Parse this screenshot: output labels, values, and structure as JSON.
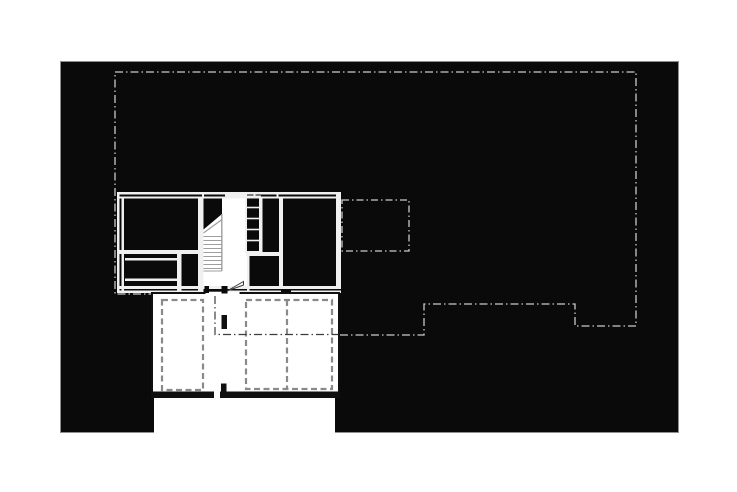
{
  "page": {
    "width": 737,
    "height": 492,
    "title": "upper-floor-plan-drawing"
  },
  "palette": {
    "page_bg": "#ffffff",
    "canvas_bg": "#0a0a0a",
    "wall_white": "#f0f0f0",
    "line_light": "#c9c9c9",
    "line_gray": "#9e9e9e",
    "line_dark": "#8a8a8a",
    "ink": "#101010",
    "ink_soft": "#3c3c3c",
    "canvas_border": "#8f8f8f"
  },
  "canvas": {
    "x": 60,
    "y": 61,
    "w": 619,
    "h": 372,
    "border_px": 1
  },
  "notch": {
    "x": 154,
    "y": 397,
    "w": 181,
    "h": 36
  },
  "drawing": {
    "elements": [
      {
        "name": "eaves-overhang-outline",
        "type": "polygon",
        "points": [
          [
            115,
            72
          ],
          [
            636,
            72
          ],
          [
            636,
            326
          ],
          [
            575,
            326
          ],
          [
            575,
            304
          ],
          [
            424,
            304
          ],
          [
            424,
            335
          ],
          [
            215,
            335
          ],
          [
            215,
            294
          ],
          [
            115,
            294
          ]
        ],
        "fill": "none",
        "stroke": "line_light",
        "sw": 1.3,
        "dash": "8 3 1.5 3"
      },
      {
        "name": "annex-dashed-outline",
        "type": "rect",
        "x": 342,
        "y": 200,
        "w": 67,
        "h": 51,
        "fill": "none",
        "stroke": "line_light",
        "sw": 1.3,
        "dash": "7 3 1.5 3"
      },
      {
        "name": "stair-hall-floor",
        "type": "rect",
        "x": 203.5,
        "y": 198,
        "w": 43.5,
        "h": 90,
        "fill": "page_bg"
      },
      {
        "name": "stair-upper-flight-mask",
        "type": "polygon",
        "points": [
          [
            203.5,
            198
          ],
          [
            222,
            198
          ],
          [
            222,
            214
          ],
          [
            203.5,
            229.5
          ]
        ],
        "fill": "canvas_bg"
      },
      {
        "name": "stair-break-line",
        "type": "line",
        "x1": 203.5,
        "y1": 233,
        "x2": 222,
        "y2": 219.5,
        "stroke": "line_gray",
        "sw": 1.2
      },
      {
        "name": "stair-tread",
        "type": "line",
        "x1": 203.5,
        "y1": 236.5,
        "x2": 221.5,
        "y2": 236.5,
        "stroke": "line_gray",
        "sw": 1.1
      },
      {
        "name": "stair-tread",
        "type": "line",
        "x1": 203.5,
        "y1": 240.5,
        "x2": 221.5,
        "y2": 240.5,
        "stroke": "line_gray",
        "sw": 1.1
      },
      {
        "name": "stair-tread",
        "type": "line",
        "x1": 203.5,
        "y1": 244.5,
        "x2": 221.5,
        "y2": 244.5,
        "stroke": "line_gray",
        "sw": 1.1
      },
      {
        "name": "stair-tread",
        "type": "line",
        "x1": 203.5,
        "y1": 248.5,
        "x2": 221.5,
        "y2": 248.5,
        "stroke": "line_gray",
        "sw": 1.1
      },
      {
        "name": "stair-tread",
        "type": "line",
        "x1": 203.5,
        "y1": 252.5,
        "x2": 221.5,
        "y2": 252.5,
        "stroke": "line_gray",
        "sw": 1.1
      },
      {
        "name": "stair-tread",
        "type": "line",
        "x1": 203.5,
        "y1": 256.5,
        "x2": 221.5,
        "y2": 256.5,
        "stroke": "line_gray",
        "sw": 1.1
      },
      {
        "name": "stair-tread",
        "type": "line",
        "x1": 203.5,
        "y1": 260.5,
        "x2": 221.5,
        "y2": 260.5,
        "stroke": "line_gray",
        "sw": 1.1
      },
      {
        "name": "stair-tread",
        "type": "line",
        "x1": 203.5,
        "y1": 264.5,
        "x2": 221.5,
        "y2": 264.5,
        "stroke": "line_gray",
        "sw": 1.1
      },
      {
        "name": "stair-tread",
        "type": "line",
        "x1": 203.5,
        "y1": 268.5,
        "x2": 221.5,
        "y2": 268.5,
        "stroke": "line_gray",
        "sw": 1.1
      },
      {
        "name": "stair-side-rail",
        "type": "line",
        "x1": 221.8,
        "y1": 214,
        "x2": 221.8,
        "y2": 271,
        "stroke": "line_gray",
        "sw": 1.4
      },
      {
        "name": "stair-landing-edge",
        "type": "line",
        "x1": 203.5,
        "y1": 271,
        "x2": 221.8,
        "y2": 271,
        "stroke": "line_gray",
        "sw": 1.1
      },
      {
        "name": "north-wall-outer",
        "type": "rect",
        "x": 117,
        "y": 192,
        "w": 224,
        "h": 2.5,
        "fill": "wall_white"
      },
      {
        "name": "north-wall-inner",
        "type": "rect",
        "x": 117,
        "y": 196.5,
        "w": 224,
        "h": 2,
        "fill": "wall_white"
      },
      {
        "name": "west-wall-outer",
        "type": "rect",
        "x": 117,
        "y": 192,
        "w": 2.5,
        "h": 101,
        "fill": "wall_white"
      },
      {
        "name": "west-wall-inner",
        "type": "rect",
        "x": 121.5,
        "y": 196.5,
        "w": 2.5,
        "h": 96.5,
        "fill": "wall_white"
      },
      {
        "name": "east-wall",
        "type": "rect",
        "x": 336,
        "y": 192,
        "w": 5,
        "h": 96,
        "fill": "wall_white"
      },
      {
        "name": "south-wall-outer",
        "type": "rect",
        "x": 117,
        "y": 286,
        "w": 224,
        "h": 3,
        "fill": "wall_white"
      },
      {
        "name": "south-wall-inner",
        "type": "rect",
        "x": 117,
        "y": 290.5,
        "w": 224,
        "h": 2.5,
        "fill": "wall_white"
      },
      {
        "name": "stair-west-wall",
        "type": "rect",
        "x": 198,
        "y": 196.5,
        "w": 5.5,
        "h": 96.5,
        "fill": "wall_white"
      },
      {
        "name": "living-room-south-wall",
        "type": "rect",
        "x": 117,
        "y": 250,
        "w": 86,
        "h": 4,
        "fill": "wall_white"
      },
      {
        "name": "storage-counter-line",
        "type": "rect",
        "x": 125,
        "y": 258,
        "w": 56.5,
        "h": 2.5,
        "fill": "wall_white"
      },
      {
        "name": "storage-divider-line",
        "type": "rect",
        "x": 125,
        "y": 278.5,
        "w": 56.5,
        "h": 2.5,
        "fill": "wall_white"
      },
      {
        "name": "storage-east-wall",
        "type": "rect",
        "x": 177,
        "y": 250,
        "w": 4.5,
        "h": 43,
        "fill": "wall_white"
      },
      {
        "name": "closet-south-wall",
        "type": "rect",
        "x": 246,
        "y": 252,
        "w": 37,
        "h": 4,
        "fill": "wall_white"
      },
      {
        "name": "mid-room-west-wall",
        "type": "rect",
        "x": 260,
        "y": 196.5,
        "w": 2.5,
        "h": 55.5,
        "fill": "wall_white"
      },
      {
        "name": "east-room-west-wall",
        "type": "rect",
        "x": 279,
        "y": 196.5,
        "w": 4,
        "h": 91.5,
        "fill": "wall_white"
      },
      {
        "name": "lower-mid-room-west-wall",
        "type": "rect",
        "x": 247,
        "y": 256,
        "w": 2.5,
        "h": 34.5,
        "fill": "wall_white"
      },
      {
        "name": "window-infill",
        "type": "rect",
        "x": 225,
        "y": 192,
        "w": 22,
        "h": 6.5,
        "fill": "wall_white"
      },
      {
        "name": "wall-tick",
        "type": "rect",
        "x": 202,
        "y": 192,
        "w": 2,
        "h": 6.5,
        "fill": "wall_white"
      },
      {
        "name": "wall-tick",
        "type": "rect",
        "x": 253.5,
        "y": 192,
        "w": 2,
        "h": 6.5,
        "fill": "wall_white"
      },
      {
        "name": "wall-tick",
        "type": "rect",
        "x": 276.5,
        "y": 192,
        "w": 2,
        "h": 6.5,
        "fill": "wall_white"
      },
      {
        "name": "shelf-unit-outline",
        "type": "rect",
        "x": 246,
        "y": 196.5,
        "w": 14,
        "h": 55.5,
        "fill": "none",
        "stroke": "wall_white",
        "sw": 2
      },
      {
        "name": "shelf-rung",
        "type": "line",
        "x1": 246,
        "y1": 207.5,
        "x2": 260,
        "y2": 207.5,
        "stroke": "wall_white",
        "sw": 1.6
      },
      {
        "name": "shelf-rung",
        "type": "line",
        "x1": 246,
        "y1": 218.5,
        "x2": 260,
        "y2": 218.5,
        "stroke": "wall_white",
        "sw": 1.6
      },
      {
        "name": "shelf-rung",
        "type": "line",
        "x1": 246,
        "y1": 229.5,
        "x2": 260,
        "y2": 229.5,
        "stroke": "wall_white",
        "sw": 1.6
      },
      {
        "name": "shelf-rung",
        "type": "line",
        "x1": 246,
        "y1": 240.5,
        "x2": 260,
        "y2": 240.5,
        "stroke": "wall_white",
        "sw": 1.6
      },
      {
        "name": "door-opening-gap",
        "type": "rect",
        "x": 203.5,
        "y": 290,
        "w": 21,
        "h": 3.5,
        "fill": "canvas_bg"
      },
      {
        "name": "south-wall-opening",
        "type": "rect",
        "x": 281,
        "y": 290.5,
        "w": 10,
        "h": 2.5,
        "fill": "canvas_bg"
      },
      {
        "name": "garage-block",
        "type": "rect",
        "x": 152,
        "y": 293,
        "w": 187,
        "h": 104,
        "fill": "page_bg",
        "stroke": "ink",
        "sw": 2
      },
      {
        "name": "garage-south-wall",
        "type": "rect",
        "x": 152,
        "y": 391.5,
        "w": 187,
        "h": 5.5,
        "fill": "ink"
      },
      {
        "name": "garage-north-opening",
        "type": "rect",
        "x": 205.5,
        "y": 291.7,
        "w": 34,
        "h": 3.6,
        "fill": "page_bg"
      },
      {
        "name": "garage-door-gap",
        "type": "rect",
        "x": 214,
        "y": 390.5,
        "w": 6,
        "h": 8.5,
        "fill": "page_bg"
      },
      {
        "name": "car-stall-left",
        "type": "rect",
        "x": 162,
        "y": 300,
        "w": 41,
        "h": 90,
        "fill": "none",
        "stroke": "line_dark",
        "sw": 2.2,
        "dash": "6 3.5"
      },
      {
        "name": "car-stall-right-outer",
        "type": "rect",
        "x": 246,
        "y": 300,
        "w": 86,
        "h": 89,
        "fill": "none",
        "stroke": "line_dark",
        "sw": 2.2,
        "dash": "6 3.5"
      },
      {
        "name": "car-stall-divider",
        "type": "line",
        "x1": 287,
        "y1": 300,
        "x2": 287,
        "y2": 389,
        "stroke": "line_dark",
        "sw": 2.2,
        "dash": "6 3.5"
      },
      {
        "name": "eaves-line-inside-garage",
        "type": "polyline",
        "points": [
          [
            215,
            296
          ],
          [
            215,
            334.5
          ],
          [
            338.5,
            334.5
          ]
        ],
        "fill": "none",
        "stroke": "ink_soft",
        "sw": 1.2,
        "dash": "8 3 1.5 3"
      },
      {
        "name": "column-post",
        "type": "rect",
        "x": 221.5,
        "y": 315,
        "w": 5.5,
        "h": 14,
        "fill": "ink"
      },
      {
        "name": "column-post",
        "type": "rect",
        "x": 221,
        "y": 383.5,
        "w": 5.5,
        "h": 11,
        "fill": "ink"
      },
      {
        "name": "door-jamb",
        "type": "rect",
        "x": 204.5,
        "y": 286,
        "w": 4.5,
        "h": 7,
        "fill": "canvas_bg"
      },
      {
        "name": "door-pivot-post",
        "type": "rect",
        "x": 221.5,
        "y": 286,
        "w": 6,
        "h": 7.5,
        "fill": "canvas_bg"
      },
      {
        "name": "door-leaf",
        "type": "polygon",
        "points": [
          [
            227,
            291
          ],
          [
            243.5,
            281.5
          ],
          [
            243.5,
            285
          ]
        ],
        "fill": "page_bg",
        "stroke": "ink_soft",
        "sw": 1
      }
    ]
  }
}
